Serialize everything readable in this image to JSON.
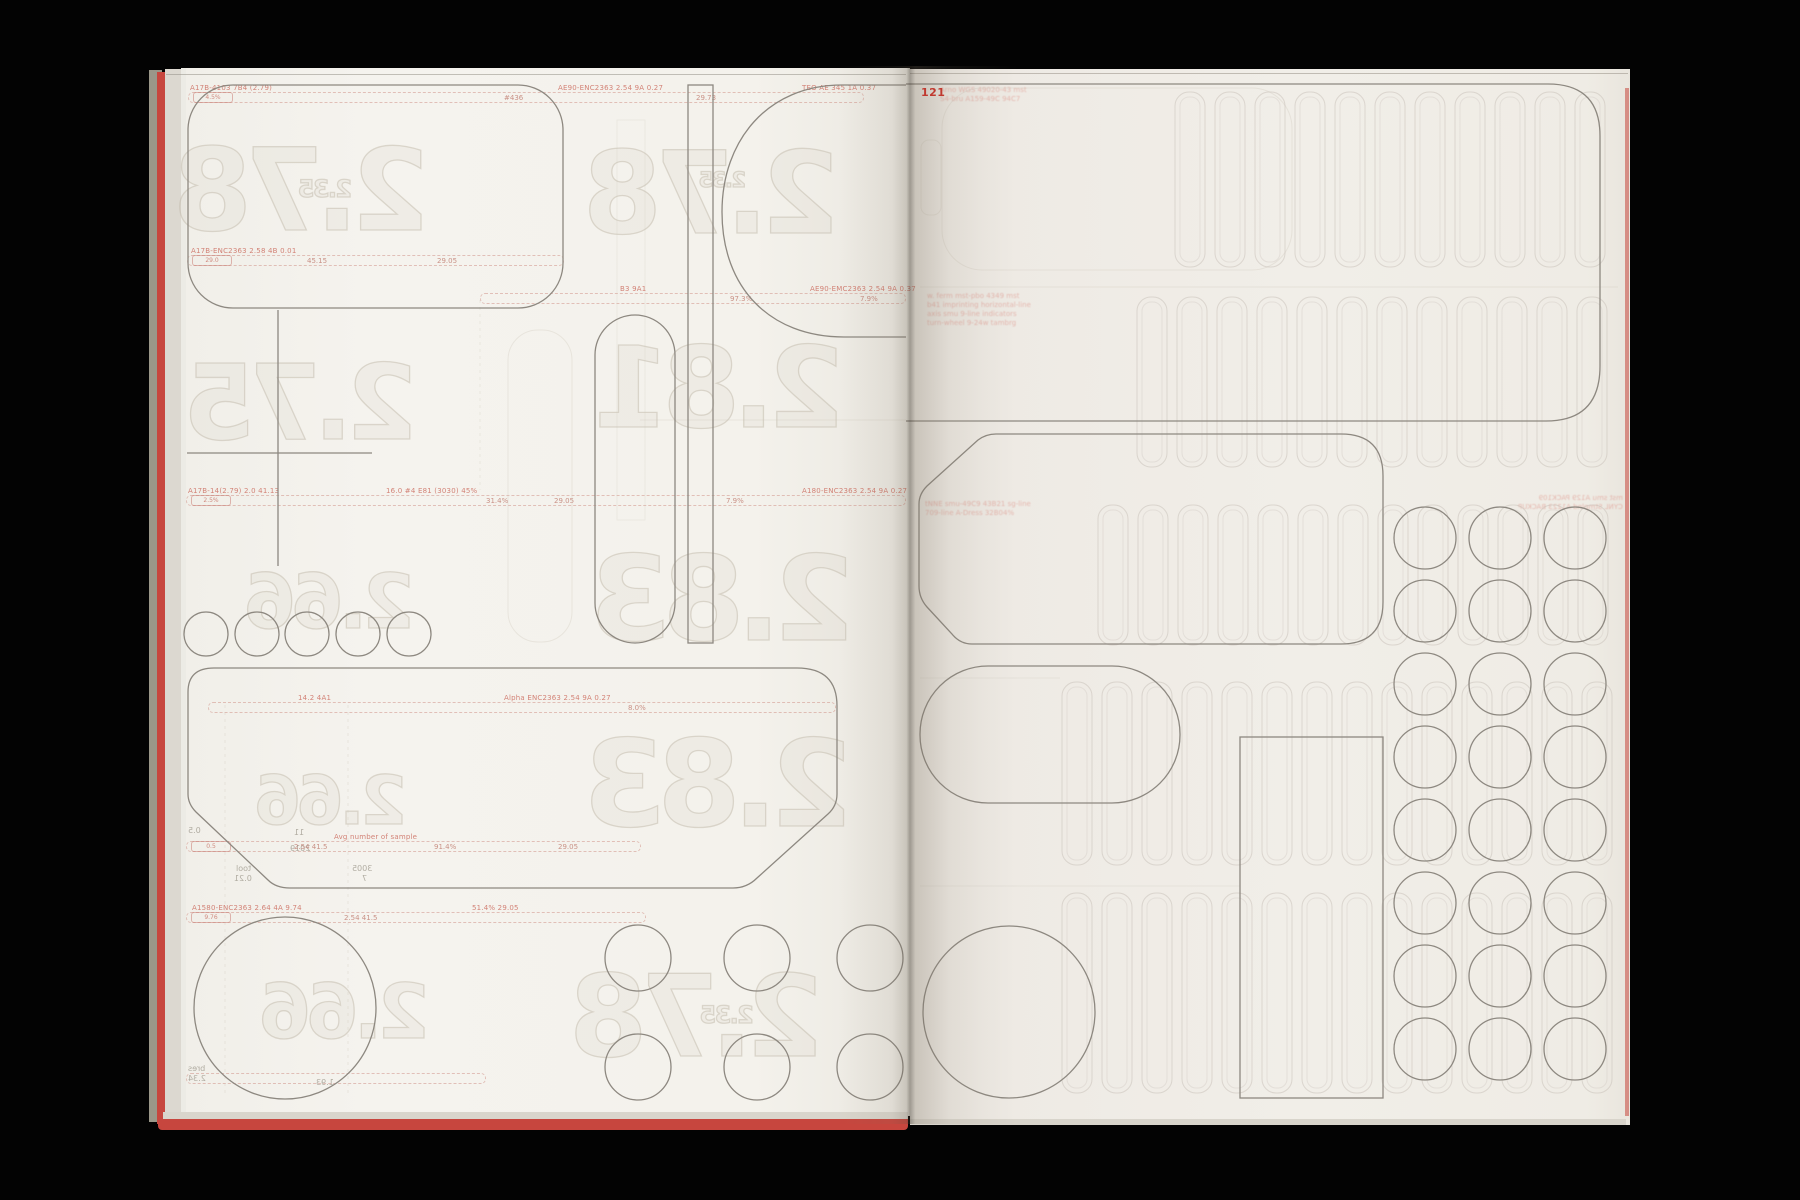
{
  "page": {
    "number": "121"
  },
  "colors": {
    "background": "#030303",
    "paper_left": "#f4f2ec",
    "paper_right": "#f0ede7",
    "cut_line": "#8d8880",
    "ghost_line": "#c9c2b6",
    "fore_edge_red": "#c7463e",
    "accent_red": "#c0392f",
    "strip_red": "#cd6e62"
  },
  "ghost_numbers": [
    {
      "t": "2.78",
      "x": 240,
      "y": 145,
      "w": 190,
      "h": 97
    },
    {
      "t": "2.35",
      "x": 300,
      "y": 180,
      "w": 52,
      "h": 20
    },
    {
      "t": "2.78",
      "x": 620,
      "y": 148,
      "w": 220,
      "h": 97
    },
    {
      "t": "2.35",
      "x": 698,
      "y": 172,
      "w": 50,
      "h": 18
    },
    {
      "t": "2.75",
      "x": 256,
      "y": 362,
      "w": 162,
      "h": 88
    },
    {
      "t": "2.81",
      "x": 640,
      "y": 345,
      "w": 205,
      "h": 95
    },
    {
      "t": "2.66",
      "x": 260,
      "y": 572,
      "w": 155,
      "h": 64
    },
    {
      "t": "2.83",
      "x": 640,
      "y": 552,
      "w": 215,
      "h": 100
    },
    {
      "t": "2.66",
      "x": 258,
      "y": 775,
      "w": 150,
      "h": 58
    },
    {
      "t": "2.83",
      "x": 618,
      "y": 738,
      "w": 235,
      "h": 102
    },
    {
      "t": "2.66",
      "x": 268,
      "y": 982,
      "w": 162,
      "h": 64
    },
    {
      "t": "2.78",
      "x": 616,
      "y": 972,
      "w": 208,
      "h": 96
    },
    {
      "t": "2.35",
      "x": 700,
      "y": 1006,
      "w": 55,
      "h": 20
    }
  ],
  "tiny_labels": [
    {
      "t": "tool",
      "x": 236,
      "y": 864
    },
    {
      "t": "0.21",
      "x": 234,
      "y": 874
    },
    {
      "t": "3005",
      "x": 352,
      "y": 864
    },
    {
      "t": "7",
      "x": 362,
      "y": 874
    },
    {
      "t": "bres",
      "x": 188,
      "y": 1064
    },
    {
      "t": "2.34",
      "x": 188,
      "y": 1074
    },
    {
      "t": "1.93",
      "x": 316,
      "y": 1078
    },
    {
      "t": "0.5",
      "x": 188,
      "y": 826
    },
    {
      "t": "11",
      "x": 294,
      "y": 828
    },
    {
      "t": "2019",
      "x": 290,
      "y": 844
    }
  ],
  "strips": [
    {
      "x": 188,
      "y": 92,
      "w": 676,
      "box": "4.5%",
      "labels": [
        {
          "dx": 2,
          "t": "A17B-4103 7B4 (2.79)"
        },
        {
          "dx": 370,
          "t": "AE90-ENC2363 2.54 9A 0.27"
        },
        {
          "dx": 614,
          "t": "TEO AE 345 1A 0.37"
        }
      ],
      "frags": [
        {
          "dx": 316,
          "t": "#436"
        },
        {
          "dx": 508,
          "t": "29.73"
        }
      ]
    },
    {
      "x": 187,
      "y": 255,
      "w": 377,
      "box": "29.0",
      "labels": [
        {
          "dx": 4,
          "t": "A17B-ENC2363 2.58 4B 0.01"
        }
      ],
      "frags": [
        {
          "dx": 120,
          "t": "45.15"
        },
        {
          "dx": 250,
          "t": "29.05"
        }
      ]
    },
    {
      "x": 480,
      "y": 293,
      "w": 426,
      "box": "",
      "labels": [
        {
          "dx": 140,
          "t": "B3 9A1"
        },
        {
          "dx": 330,
          "t": "AE90-EMC2363 2.54 9A 0.37"
        }
      ],
      "frags": [
        {
          "dx": 250,
          "t": "97.3%"
        },
        {
          "dx": 380,
          "t": "7.9%"
        }
      ]
    },
    {
      "x": 186,
      "y": 495,
      "w": 720,
      "box": "2.5%",
      "labels": [
        {
          "dx": 2,
          "t": "A17B-14(2.79) 2.0 41.13"
        },
        {
          "dx": 200,
          "t": "16.0 #4 E81 (3030) 45%"
        },
        {
          "dx": 616,
          "t": "A180-ENC2363 2.54 9A 0.27"
        }
      ],
      "frags": [
        {
          "dx": 300,
          "t": "31.4%"
        },
        {
          "dx": 368,
          "t": "29.05"
        },
        {
          "dx": 540,
          "t": "7.9%"
        }
      ]
    },
    {
      "x": 208,
      "y": 702,
      "w": 628,
      "box": "",
      "labels": [
        {
          "dx": 90,
          "t": "14.2 4A1"
        },
        {
          "dx": 296,
          "t": "Alpha ENC2363 2.54 9A 0.27"
        }
      ],
      "frags": [
        {
          "dx": 420,
          "t": "8.0%"
        }
      ]
    },
    {
      "x": 186,
      "y": 841,
      "w": 455,
      "box": "0.5",
      "labels": [
        {
          "dx": 148,
          "t": "Avg number of sample"
        }
      ],
      "frags": [
        {
          "dx": 108,
          "t": "2.54 41.5"
        },
        {
          "dx": 248,
          "t": "91.4%"
        },
        {
          "dx": 372,
          "t": "29.05"
        }
      ]
    },
    {
      "x": 186,
      "y": 912,
      "w": 460,
      "box": "9.76",
      "labels": [
        {
          "dx": 6,
          "t": "A1580-ENC2363 2.64 4A 9.74"
        },
        {
          "dx": 286,
          "t": "51.4%  29.05"
        }
      ],
      "frags": [
        {
          "dx": 158,
          "t": "2.54 41.5"
        }
      ]
    },
    {
      "x": 186,
      "y": 1073,
      "w": 300,
      "box": "",
      "labels": [],
      "frags": []
    }
  ],
  "text_blocks": [
    {
      "x": 940,
      "y": 86,
      "mirror": false,
      "lines": [
        "Arno WGS 49020-43 mst",
        "S4-bru A159-49C 94C7"
      ]
    },
    {
      "x": 927,
      "y": 292,
      "mirror": false,
      "lines": [
        "w. ferm mst-pbo 4349 mst",
        "b41 imprinting horizontal-line",
        "axis smu 9-line indicators",
        "turn-wheel 9-24w tambrg"
      ]
    },
    {
      "x": 925,
      "y": 500,
      "mirror": false,
      "lines": [
        "tNNE smu-49C9 43B21 sg-line",
        "709-line A-Dress 32B04%"
      ]
    },
    {
      "x": 1518,
      "y": 494,
      "mirror": true,
      "lines": [
        "mst smu A129 PACK109",
        "CYNL Stmplnd A1223 BACKUP"
      ]
    }
  ],
  "cut_shapes": [
    {
      "el": "rect",
      "name": "cut-rounded-rect-topleft",
      "a": {
        "x": 188,
        "y": 85,
        "width": 375,
        "height": 223,
        "rx": 45
      }
    },
    {
      "el": "path",
      "name": "cut-capsule-top",
      "a": {
        "d": "M 906 85 L 842 85 C 768 85 722 140 722 212 C 722 288 770 337 844 337 L 906 337"
      }
    },
    {
      "el": "rect",
      "name": "cut-tall-rect",
      "a": {
        "x": 688,
        "y": 85,
        "width": 25,
        "height": 558
      }
    },
    {
      "el": "rect",
      "name": "cut-pill-vertical",
      "a": {
        "x": 595,
        "y": 315,
        "width": 80,
        "height": 328,
        "rx": 40
      }
    },
    {
      "el": "line",
      "name": "cut-cross-horizontal",
      "a": {
        "x1": 187,
        "y1": 453,
        "x2": 372,
        "y2": 453
      }
    },
    {
      "el": "line",
      "name": "cut-cross-vertical",
      "a": {
        "x1": 278,
        "y1": 310,
        "x2": 278,
        "y2": 566
      }
    },
    {
      "el": "circle",
      "name": "cut-small-circle",
      "a": {
        "cx": 206,
        "cy": 634,
        "r": 22
      }
    },
    {
      "el": "circle",
      "name": "cut-small-circle",
      "a": {
        "cx": 257,
        "cy": 634,
        "r": 22
      }
    },
    {
      "el": "circle",
      "name": "cut-small-circle",
      "a": {
        "cx": 307,
        "cy": 634,
        "r": 22
      }
    },
    {
      "el": "circle",
      "name": "cut-small-circle",
      "a": {
        "cx": 358,
        "cy": 634,
        "r": 22
      }
    },
    {
      "el": "circle",
      "name": "cut-small-circle",
      "a": {
        "cx": 409,
        "cy": 634,
        "r": 22
      }
    },
    {
      "el": "path",
      "name": "cut-hexagon",
      "a": {
        "d": "M 214 668 L 797 668 Q 837 668 837 706 L 837 794 Q 837 806 828 814 L 757 878 Q 747 888 733 888 L 290 888 Q 276 888 268 880 L 196 812 Q 188 804 188 794 L 188 692 Q 188 668 214 668 Z"
      }
    },
    {
      "el": "circle",
      "name": "cut-large-circle-left",
      "a": {
        "cx": 285,
        "cy": 1008,
        "r": 91
      }
    },
    {
      "el": "circle",
      "name": "cut-medium-circle",
      "a": {
        "cx": 638,
        "cy": 958,
        "r": 33
      }
    },
    {
      "el": "circle",
      "name": "cut-medium-circle",
      "a": {
        "cx": 757,
        "cy": 958,
        "r": 33
      }
    },
    {
      "el": "circle",
      "name": "cut-medium-circle",
      "a": {
        "cx": 870,
        "cy": 958,
        "r": 33
      }
    },
    {
      "el": "circle",
      "name": "cut-medium-circle",
      "a": {
        "cx": 638,
        "cy": 1067,
        "r": 33
      }
    },
    {
      "el": "circle",
      "name": "cut-medium-circle",
      "a": {
        "cx": 757,
        "cy": 1067,
        "r": 33
      }
    },
    {
      "el": "circle",
      "name": "cut-medium-circle",
      "a": {
        "cx": 870,
        "cy": 1067,
        "r": 33
      }
    },
    {
      "el": "path",
      "name": "cut-big-rect-right",
      "a": {
        "d": "M 906 84 L 1548 84 Q 1600 84 1600 136 L 1600 366 Q 1600 421 1546 421 L 906 421"
      }
    },
    {
      "el": "path",
      "name": "cut-octagon",
      "a": {
        "d": "M 996 434 L 1341 434 Q 1383 434 1383 476 L 1383 602 Q 1383 644 1341 644 L 972 644 Q 960 644 952 634 L 927 607 Q 919 598 919 586 L 919 504 Q 919 494 927 486 L 978 440 Q 986 434 996 434 Z"
      }
    },
    {
      "el": "rect",
      "name": "cut-pill-horizontal",
      "a": {
        "x": 920,
        "y": 666,
        "width": 260,
        "height": 137,
        "rx": 68
      }
    },
    {
      "el": "circle",
      "name": "cut-large-circle-right",
      "a": {
        "cx": 1009,
        "cy": 1012,
        "r": 86
      }
    },
    {
      "el": "rect",
      "name": "cut-tall-rect-right",
      "a": {
        "x": 1240,
        "y": 737,
        "width": 143,
        "height": 361
      }
    }
  ],
  "circle_grid": {
    "cx": [
      1425,
      1500,
      1575
    ],
    "cy": [
      538,
      611,
      684,
      757,
      830,
      903,
      976,
      1049
    ],
    "r": 31
  },
  "ghost_shapes": [
    {
      "el": "rect",
      "o": 0.3,
      "a": {
        "x": 942,
        "y": 88,
        "width": 350,
        "height": 182,
        "rx": 40
      }
    },
    {
      "el": "rect",
      "o": 0.3,
      "a": {
        "x": 921,
        "y": 140,
        "width": 20,
        "height": 75,
        "rx": 8
      }
    },
    {
      "el": "rect",
      "o": 0.3,
      "a": {
        "x": 508,
        "y": 330,
        "width": 64,
        "height": 312,
        "rx": 30
      }
    },
    {
      "el": "rect",
      "o": 0.22,
      "a": {
        "x": 617,
        "y": 120,
        "width": 28,
        "height": 400
      }
    }
  ],
  "ghost_lines": [
    {
      "x1": 920,
      "y1": 287,
      "x2": 1618,
      "y2": 287,
      "o": 0.3
    },
    {
      "x1": 640,
      "y1": 420,
      "x2": 906,
      "y2": 420,
      "o": 0.3
    },
    {
      "x1": 920,
      "y1": 678,
      "x2": 1060,
      "y2": 678,
      "o": 0.25
    },
    {
      "x1": 920,
      "y1": 886,
      "x2": 1240,
      "y2": 886,
      "o": 0.25
    },
    {
      "x1": 225,
      "y1": 705,
      "x2": 225,
      "y2": 1095,
      "o": 0.3,
      "dash": "3 4"
    },
    {
      "x1": 348,
      "y1": 705,
      "x2": 348,
      "y2": 1095,
      "o": 0.3,
      "dash": "3 4"
    },
    {
      "x1": 480,
      "y1": 300,
      "x2": 480,
      "y2": 490,
      "o": 0.25,
      "dash": "3 4"
    }
  ],
  "slot_bands": [
    {
      "x1": 1175,
      "x2": 1618,
      "y": 92,
      "h": 175
    },
    {
      "x1": 1137,
      "x2": 1618,
      "y": 297,
      "h": 170
    },
    {
      "x1": 1098,
      "x2": 1618,
      "y": 505,
      "h": 140
    },
    {
      "x1": 1062,
      "x2": 1618,
      "y": 682,
      "h": 183
    },
    {
      "x1": 1062,
      "x2": 1618,
      "y": 893,
      "h": 200
    }
  ]
}
